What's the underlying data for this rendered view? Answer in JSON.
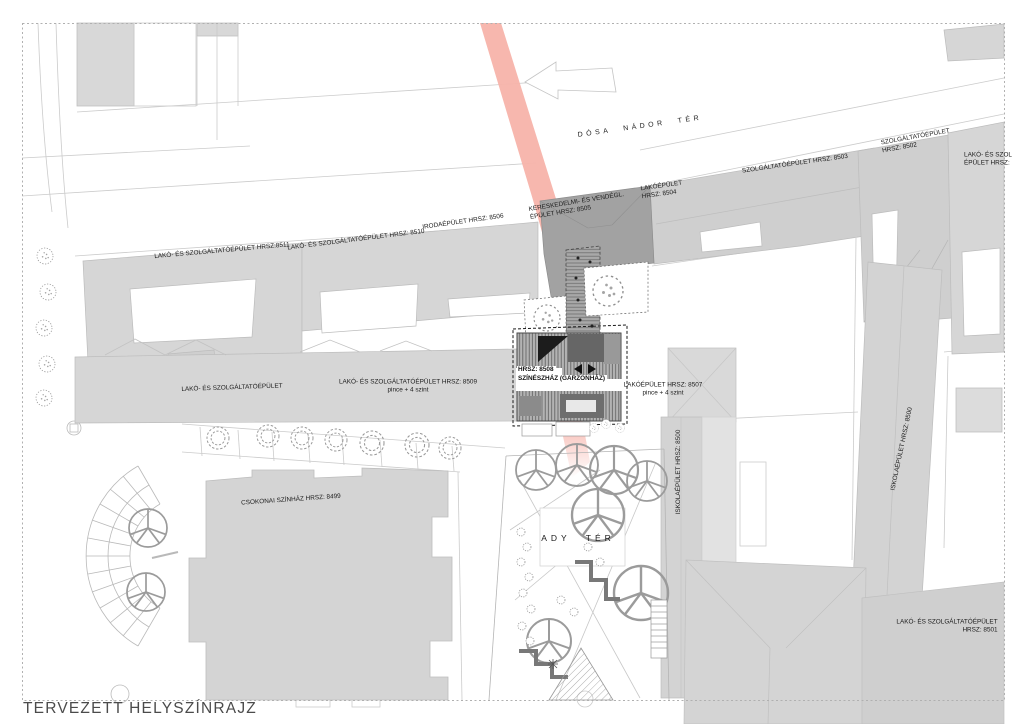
{
  "title": "TERVEZETT HELYSZÍNRAJZ",
  "streets": {
    "dosa_nador_ter": "DÓSA NÁDOR TÉR",
    "ady_ter": "ADY TÉR"
  },
  "buildings": {
    "b8511": {
      "line1": "LAKÓ- ÉS SZOLGÁLTATÓÉPÜLET HRSZ:8511"
    },
    "b8510": {
      "line1": "LAKÓ- ÉS SZOLGÁLTATÓÉPÜLET HRSZ: 8510"
    },
    "b8506": {
      "line1": "IRODAÉPÜLET HRSZ: 8506"
    },
    "b8505": {
      "line1": "KERESKEDELMI- ÉS VENDÉGL.",
      "line2": "ÉPÜLET HRSZ: 8505"
    },
    "b8504": {
      "line1": "LAKÓÉPÜLET",
      "line2": "HRSZ: 8504"
    },
    "b8503": {
      "line1": "SZOLGÁLTATÓÉPÜLET HRSZ: 8503"
    },
    "b8502": {
      "line1": "SZOLGÁLTATÓÉPÜLET",
      "line2": "HRSZ: 8502"
    },
    "b_right_edge": {
      "line1": "LAKÓ- ÉS SZOL",
      "line2": "ÉPÜLET HRSZ:"
    },
    "b_lako_szolg": {
      "line1": "LAKÓ- ÉS SZOLGÁLTATÓÉPÜLET"
    },
    "b8509": {
      "line1": "LAKÓ- ÉS SZOLGÁLTATÓÉPÜLET HRSZ: 8509",
      "line2": "pince + 4 szint"
    },
    "b8508": {
      "line1": "HRSZ: 8508",
      "line2": "SZÍNÉSZHÁZ (GARZONHÁZ)"
    },
    "b8507": {
      "line1": "LAKÓÉPÜLET HRSZ: 8507",
      "line2": "pince + 4 szint"
    },
    "b8500_left": {
      "line1": "ISKOLAÉPÜLET HRSZ: 8500"
    },
    "b8500_right": {
      "line1": "ISKOLAÉPÜLET HRSZ: 8500"
    },
    "b8499": {
      "line1": "CSOKONAI SZÍNHÁZ HRSZ: 8499"
    },
    "b8501": {
      "line1": "LAKÓ- ÉS SZOLGÁLTATÓÉPÜLET",
      "line2": "HRSZ: 8501"
    }
  },
  "colors": {
    "axis_pink": "#f7b3aa",
    "building_light": "#d6d6d6",
    "building_mid": "#cfcfcf",
    "building_dark": "#a2a2a2",
    "new_building_hatch": "#b3b3b3",
    "outline_gray": "#c4c4c4",
    "label_text": "#1b1b1b",
    "title_text": "#4b4b4b"
  }
}
